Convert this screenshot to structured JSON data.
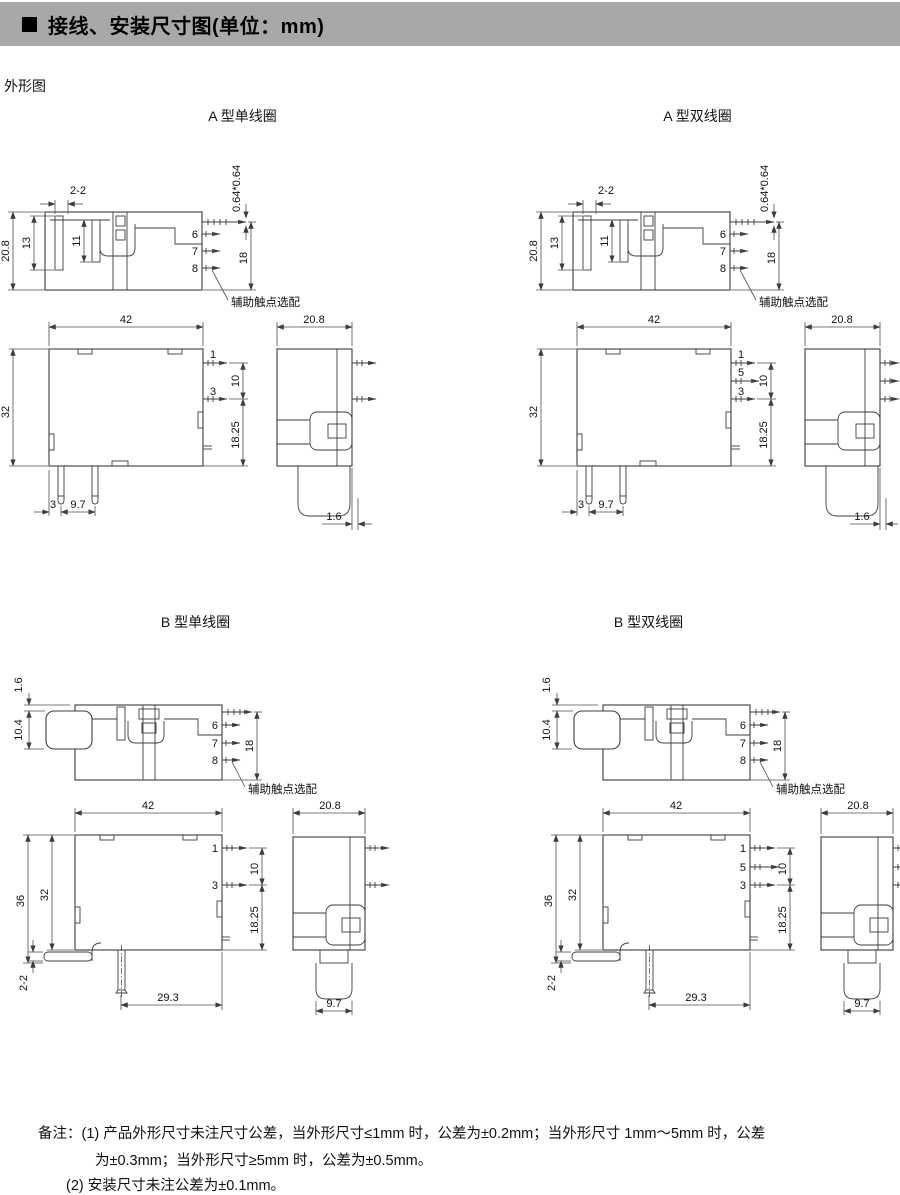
{
  "header": {
    "bullet": "■",
    "title": "接线、安装尺寸图(单位：mm)"
  },
  "outline_label": "外形图",
  "diagrams": {
    "a_single": {
      "title": "A 型单线圈"
    },
    "a_double": {
      "title": "A 型双线圈"
    },
    "b_single": {
      "title": "B 型单线圈"
    },
    "b_double": {
      "title": "B 型双线圈"
    }
  },
  "labels": {
    "aux_optional": "辅助触点选配",
    "pin1": "1",
    "pin3": "3",
    "pin5": "5",
    "pin6": "6",
    "pin7": "7",
    "pin8": "8"
  },
  "dims": {
    "slot": "2-2",
    "height_top": "20.8",
    "slot13": "13",
    "slot11": "11",
    "pin_cross": "0.64*0.64",
    "pin_row": "18",
    "width": "42",
    "height_front": "32",
    "pin_pitch": "10",
    "pin_bottom": "18.25",
    "offset3": "3",
    "pitch97": "9.7",
    "depth": "20.8",
    "pin_offset": "1.6",
    "b_step": "1.6",
    "b_hood": "10.4",
    "b_height": "36",
    "b_bracket": "2-2",
    "b_pin29": "29.3",
    "b_plug": "9.7"
  },
  "notes": {
    "label": "备注：",
    "item1_num": "(1)",
    "item1_line1": "产品外形尺寸未注尺寸公差，当外形尺寸≤1mm 时，公差为±0.2mm；当外形尺寸 1mm～5mm 时，公差",
    "item1_line2": "为±0.3mm；当外形尺寸≥5mm 时，公差为±0.5mm。",
    "item2_num": "(2)",
    "item2_text": "安装尺寸未注公差为±0.1mm。"
  }
}
